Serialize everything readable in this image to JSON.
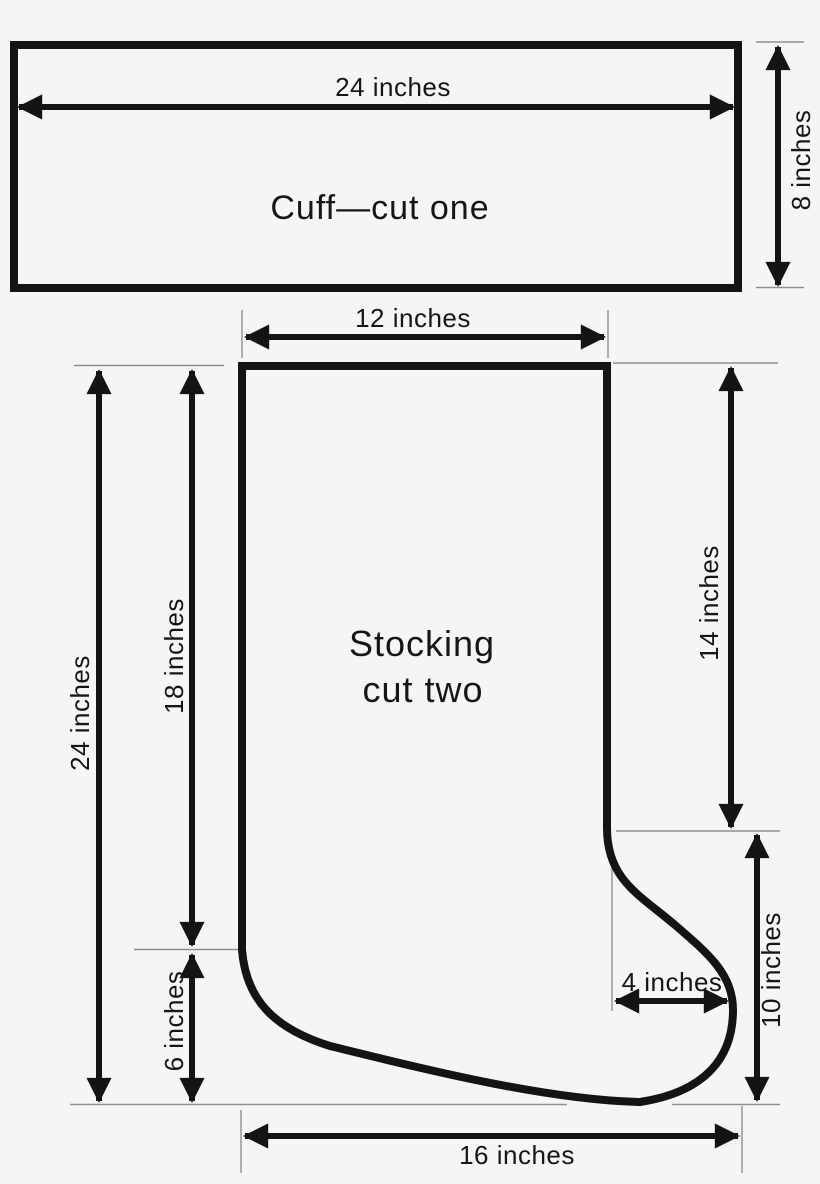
{
  "page": {
    "background": "#f5f5f5",
    "line_color": "#141414",
    "ext_line_color": "#8f8f8f"
  },
  "cuff": {
    "label": "Cuff—cut one",
    "width_dim": "24 inches",
    "height_dim": "8 inches"
  },
  "stocking": {
    "label_line1": "Stocking",
    "label_line2": "cut two",
    "top_width_dim": "12 inches",
    "overall_height_dim": "24 inches",
    "leg_height_dim": "18 inches",
    "heel_height_dim": "6 inches",
    "right_leg_dim": "14 inches",
    "foot_height_dim": "10 inches",
    "toe_width_dim": "4 inches",
    "foot_length_dim": "16 inches"
  }
}
